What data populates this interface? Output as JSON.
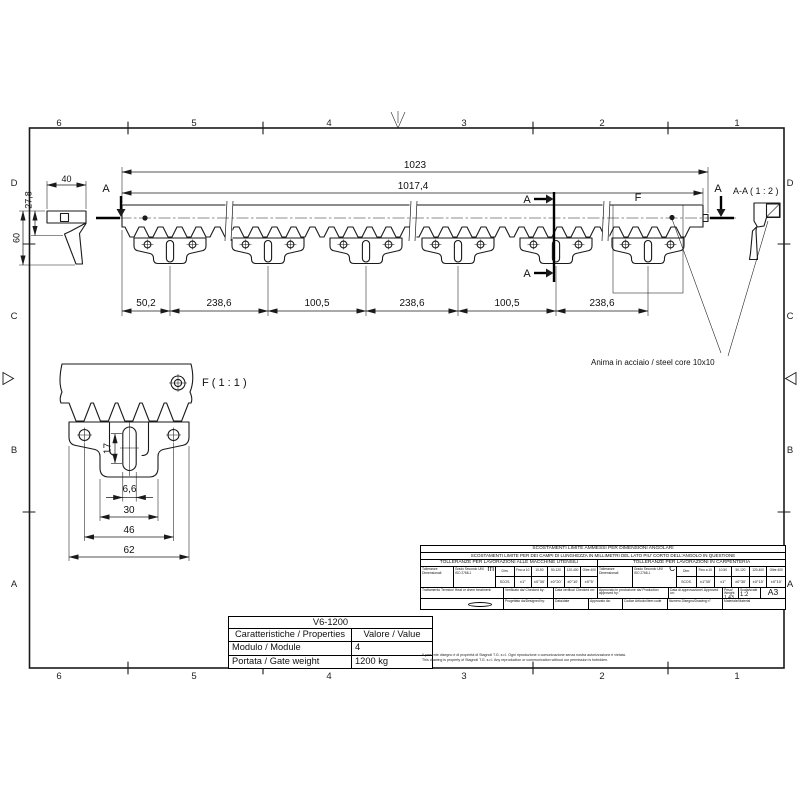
{
  "sheet": {
    "cols": [
      "6",
      "5",
      "4",
      "3",
      "2",
      "1"
    ],
    "rows": [
      "D",
      "C",
      "B",
      "A"
    ]
  },
  "views": {
    "main": {
      "dim_overall": "1023",
      "dim_body": "1017,4",
      "chain_dims": [
        "50,2",
        "238,6",
        "100,5",
        "238,6",
        "100,5",
        "238,6"
      ],
      "section_letter": "A",
      "detail_letter": "F",
      "core_note": "Anima in acciaio / steel core 10x10"
    },
    "section": {
      "label": "A-A ( 1 : 2 )"
    },
    "side": {
      "dim_width": "40",
      "dim_rack_height": "27,8",
      "dim_total_height": "60"
    },
    "detail": {
      "label": "F ( 1 : 1 )",
      "dim_slot_length": "17",
      "dim_slot_width": "6,6",
      "dim_body_width": "30",
      "dim_hole_spacing": "46",
      "dim_overall_width": "62"
    }
  },
  "properties": {
    "model": "V6-1200",
    "col_property": "Caratteristiche / Properties",
    "col_value": "Valore / Value",
    "rows": [
      {
        "label": "Modulo / Module",
        "value": "4"
      },
      {
        "label": "Portata / Gate weight",
        "value": "1200 kg"
      }
    ]
  },
  "titleblock": {
    "angular_title": "SCOSTAMENTI LIMITE AMMESSI PER DIMENSIONI ANGOLARI",
    "angular_subtitle": "SCOSTAMENTI LIMITE PER DEI CAMPI DI LUNGHEZZA IN MILLIMETRI DEL LATO PIU' CORTO DELL'ANGOLO IN QUESTIONE",
    "machining": {
      "title": "TOLLERANZE PER LAVORAZIONI ALLE MACCHINE UTENSILI",
      "tol": "Tolleranze Dimensionali",
      "grade_caption": "Grado Secondo UNI ISO 2768-1",
      "grade": "m",
      "dim": "Dim.",
      "scos": "SCOS.",
      "ranges": [
        "Fino a 10",
        "10-50",
        "50-120",
        "120-400",
        "Oltre 400"
      ],
      "values": [
        "±1°",
        "±0°30'",
        "±0°20'",
        "±0°10'",
        "±0°5'"
      ]
    },
    "carpentry": {
      "title": "TOLLERANZE PER LAVORAZIONI IN CARPENTERIA",
      "tol": "Tolleranze Dimensionali",
      "grade_caption": "Grado Secondo UNI ISO 2768-1",
      "grade": "C",
      "dim": "Dim.",
      "scos": "SCOS.",
      "ranges": [
        "Fino a 10",
        "10-50",
        "50-120",
        "120-400",
        "Oltre 400"
      ],
      "values": [
        "±1°30'",
        "±1°",
        "±0°30'",
        "±0°15'",
        "±0°10'"
      ]
    },
    "fields": {
      "treatment": "Trattamento Termico/ Heat or chem treatment:",
      "checked_by": "Verificato da/ Checked by:",
      "checked_on": "Data verifica/ Checked on:",
      "prod_approved_by": "Approvato in produzione da/ Production approved by:",
      "approved_on": "Data di approvazione/ Approved on:",
      "weight_label": "Peso/ Weight",
      "weight": "1,43 kg",
      "scale_label": "Scala/scale",
      "scale": "1:2",
      "format": "A3",
      "designed_by": "Progettato da/Designed by:",
      "date": "Data/date",
      "approved_by": "Approvato da:",
      "item_code": "Codice Articolo/Item code",
      "drawing_no": "Numero Disegno/Drawing n°",
      "material": "Materiale/Material"
    },
    "disclaimer_it": "Il presente disegno è di proprietà di Stagnoli T.G. s.r.l. Ogni riproduzione o comunicazione senza nostra autorizzazione è vietata.",
    "disclaimer_en": "This drawing is property of Stagnoli T.G. s.r.l. Any reproduction or communication without our permission is forbidden."
  }
}
